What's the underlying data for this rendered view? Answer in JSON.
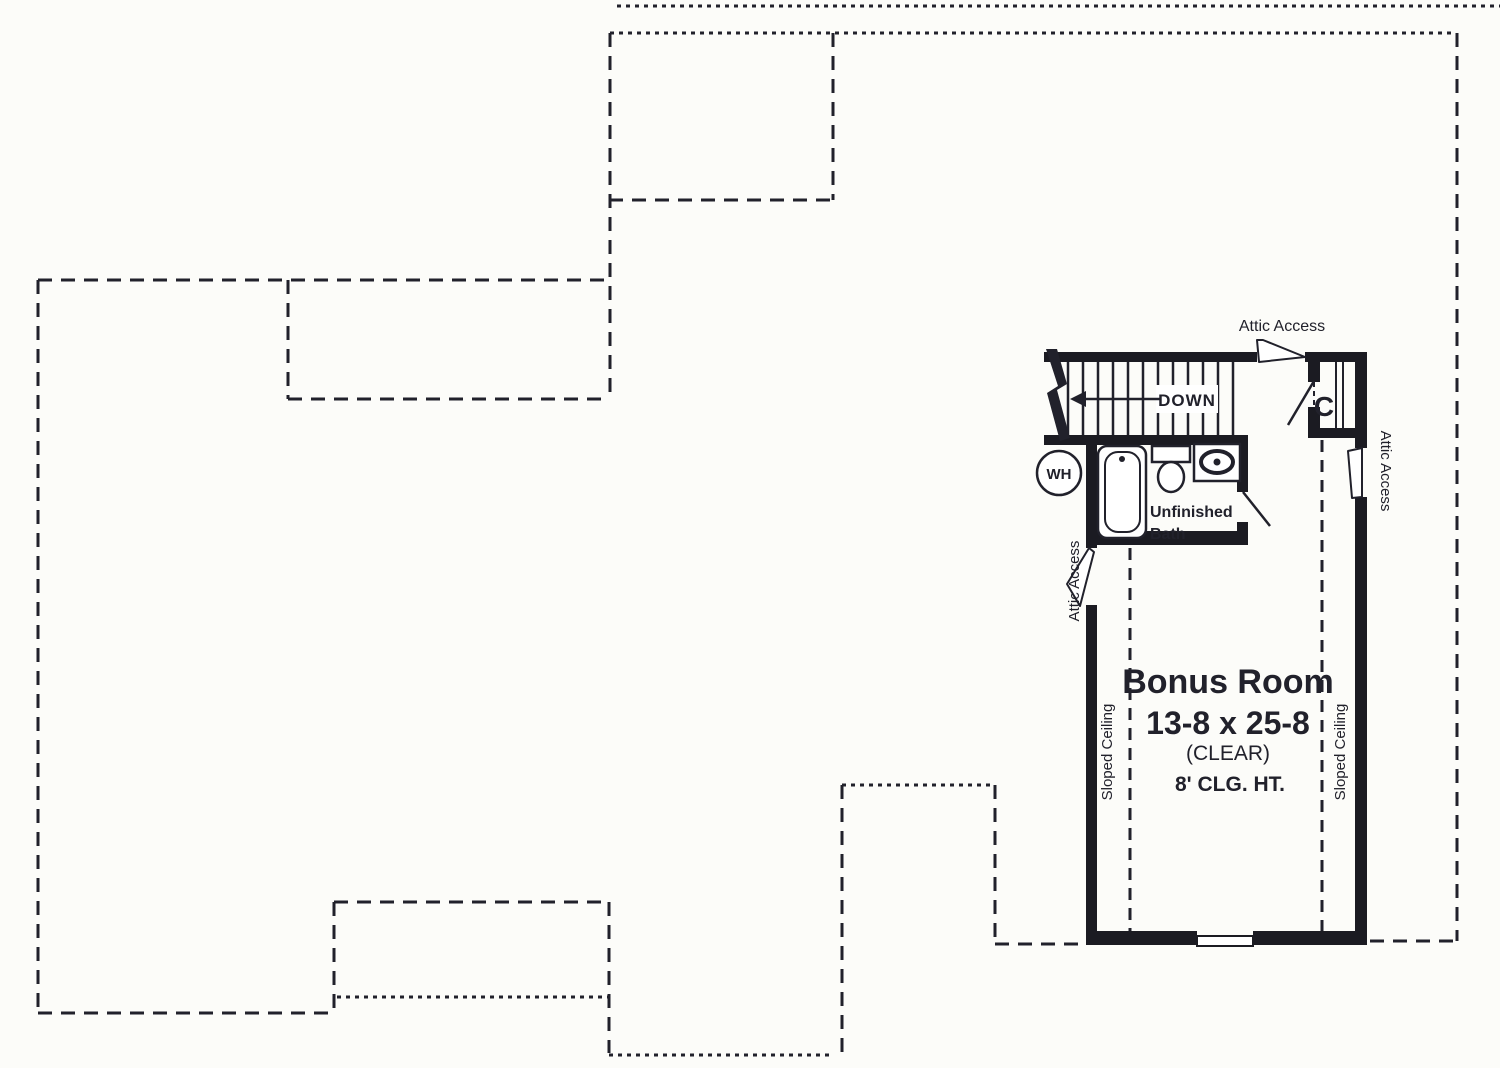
{
  "colors": {
    "background": "#fcfcf9",
    "ink": "#21212b",
    "wall": "#1b1b22"
  },
  "plan": {
    "stairs": {
      "down_label": "DOWN"
    },
    "water_heater_label": "WH",
    "closet_label": "C",
    "bath": {
      "line1": "Unfinished",
      "line2": "Bath"
    },
    "attic_access": {
      "top": "Attic Access",
      "left": "Attic Access",
      "right": "Attic Access"
    },
    "bonus_room": {
      "name": "Bonus Room",
      "dimensions": "13-8 x 25-8",
      "clear": "(CLEAR)",
      "ceiling_height": "8' CLG. HT.",
      "sloped_ceiling_left": "Sloped Ceiling",
      "sloped_ceiling_right": "Sloped Ceiling"
    }
  }
}
